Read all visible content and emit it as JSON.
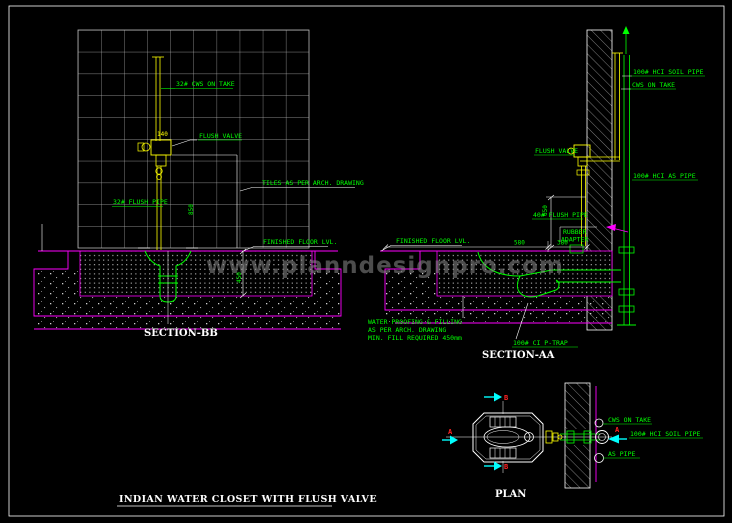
{
  "drawing": {
    "watermark": "www.planndesignpro.com",
    "main_title": "INDIAN  WATER  CLOSET  WITH  FLUSH  VALVE"
  },
  "section_bb": {
    "title": "SECTION-BB",
    "labels": {
      "cws_on_take": "32# CWS ON TAKE",
      "flush_valve": "FLUSH VALVE",
      "flush_pipe": "32# FLUSH PIPE",
      "tiles": "TILES AS PER ARCH. DRAWING",
      "finished_floor": "FINISHED FLOOR LVL."
    },
    "dims": {
      "valve_offset": "140",
      "valve_height": "850",
      "fill_depth": "450"
    }
  },
  "section_aa": {
    "title": "SECTION-AA",
    "labels": {
      "soil_pipe": "100# HCI SOIL PIPE",
      "cws_on_take": "CWS ON TAKE",
      "flush_valve": "FLUSH VALVE",
      "as_pipe": "100# HCI AS PIPE",
      "flush_pipe": "40# FLUSH PIPE",
      "rubber_adapter_line1": "RUBBER",
      "rubber_adapter_line2": "ADAPTER",
      "finished_floor": "FINISHED FLOOR LVL.",
      "p_trap": "100# CI P-TRAP",
      "waterproof_line1": "WATER PROOFING & FILLING",
      "waterproof_line2": "AS PER ARCH. DRAWING",
      "waterproof_line3": "MIN. FILL REQUIRED 450mm"
    },
    "dims": {
      "pan_height": "650",
      "pan_to_wall": "580",
      "trap_offset": "380"
    }
  },
  "plan": {
    "title": "PLAN",
    "labels": {
      "cws_on_take": "CWS ON TAKE",
      "soil_pipe": "100# HCI SOIL PIPE",
      "as_pipe": "AS PIPE"
    },
    "markers": {
      "a": "A",
      "b": "B"
    }
  },
  "colors": {
    "background": "#000000",
    "annotation_green": "#00ff00",
    "pipe_yellow": "#ffff00",
    "floor_magenta": "#ff00ff",
    "marker_red": "#ff2222",
    "section_cyan": "#00ffff",
    "line_white": "#ffffff"
  }
}
